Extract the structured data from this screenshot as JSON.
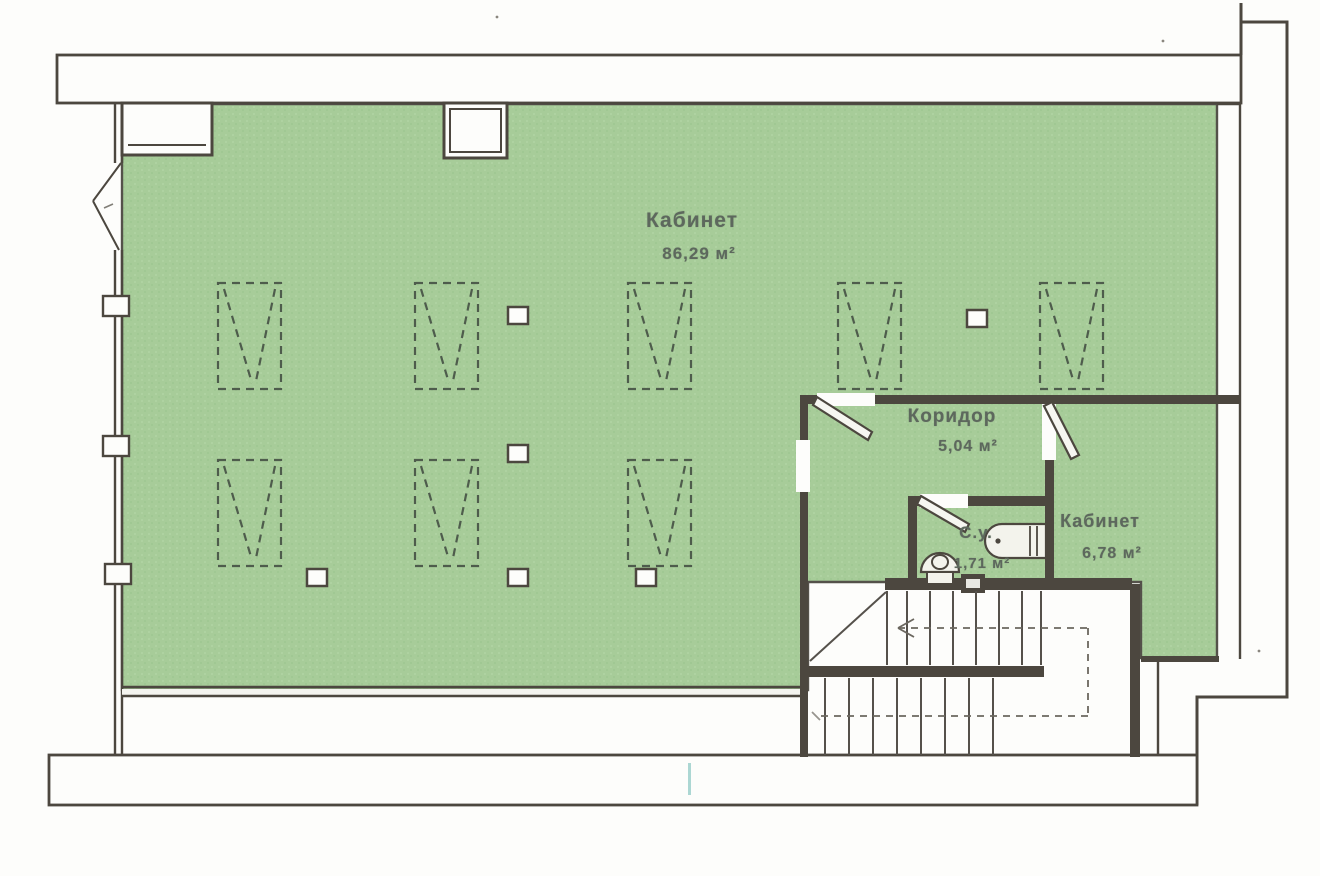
{
  "plan": {
    "rooms": {
      "office_main": {
        "name": "Кабинет",
        "area": "86,29 м²"
      },
      "corridor": {
        "name": "Коридор",
        "area": "5,04 м²"
      },
      "bathroom": {
        "name": "С.у.",
        "area": "1,71 м²"
      },
      "office_small": {
        "name": "Кабинет",
        "area": "6,78 м²"
      }
    },
    "colors": {
      "room_fill": "#a7cc99",
      "wall_line": "#4c473f",
      "paper": "#fdfdfb",
      "label_text": "#5d685d",
      "scan_artifact": "#9ed0cb"
    }
  }
}
